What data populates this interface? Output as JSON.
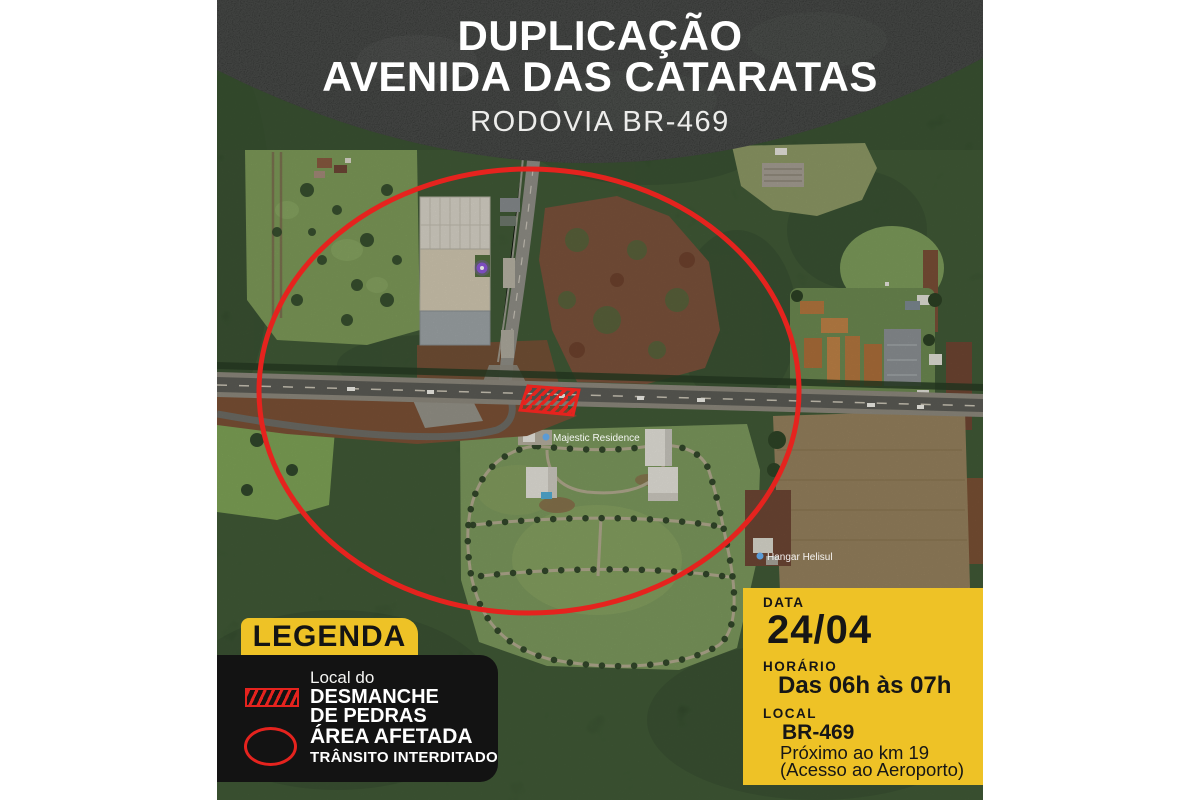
{
  "poster": {
    "header": {
      "title_line1": "DUPLICAÇÃO",
      "title_line2": "AVENIDA DAS CATARATAS",
      "subtitle": "RODOVIA BR-469"
    },
    "legend": {
      "title": "LEGENDA",
      "items": [
        {
          "swatch": "red-hatched-rectangle",
          "line1": "Local do",
          "line2": "DESMANCHE",
          "line3": "DE PEDRAS"
        },
        {
          "swatch": "red-ellipse-outline",
          "line1": "ÁREA AFETADA",
          "line2": "TRÂNSITO INTERDITADO"
        }
      ]
    },
    "info_panel": {
      "date_label": "DATA",
      "date_value": "24/04",
      "time_label": "HORÁRIO",
      "time_value": "Das 06h às 07h",
      "location_label": "LOCAL",
      "location_value": "BR-469",
      "location_detail_1": "Próximo ao km 19",
      "location_detail_2": "(Acesso ao Aeroporto)"
    },
    "map_labels": [
      {
        "text": "Majestic Residence"
      },
      {
        "text": "Hangar Helisul"
      }
    ],
    "colors": {
      "accent_red": "#e5231e",
      "accent_yellow": "#eec226",
      "panel_black": "#131313",
      "header_black": "#1c1e1c"
    }
  }
}
